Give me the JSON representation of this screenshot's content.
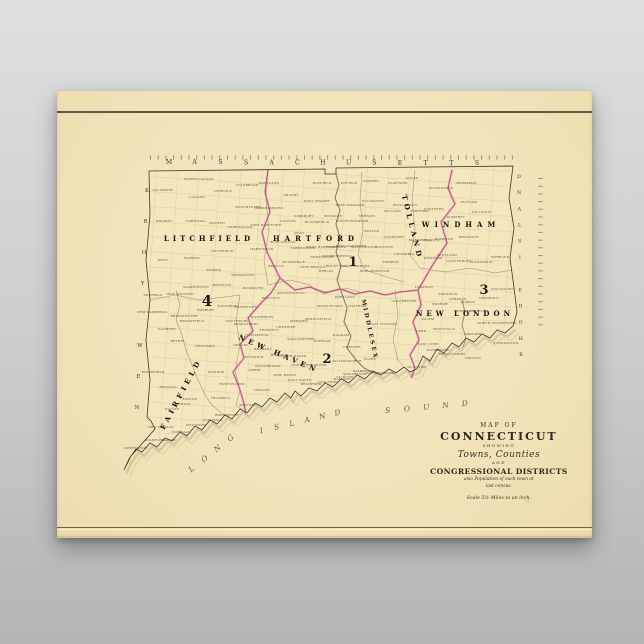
{
  "scene": {
    "background_top": "#dfdfdf",
    "background_bottom": "#b4b4b4"
  },
  "poster": {
    "paper_color": "#f1e2b8",
    "ink_color": "#3a352b",
    "district_line_color": "#c4618f",
    "page_mark": "22"
  },
  "cartouche": {
    "map_of": "MAP OF",
    "state_name": "CONNECTICUT",
    "showing": "SHOWING",
    "towns_counties": "Towns, Counties",
    "and_word": "AND",
    "congressional": "CONGRESSIONAL DISTRICTS",
    "note_line1": "also Population of each town at",
    "note_line2": "last census.",
    "scale_note": "Scale 5½ Miles to an inch."
  },
  "map": {
    "border_states": [
      {
        "name": "massachusetts-label",
        "text": "MASSACHUSETTS",
        "x1": 169,
        "y1": 164,
        "x2": 477,
        "y2": 165,
        "size": 6.2
      },
      {
        "name": "new-york-label",
        "text": "NEW YORK",
        "x1": 137,
        "y1": 409,
        "x2": 147,
        "y2": 192,
        "size": 5.4
      },
      {
        "name": "rhode-island-label",
        "text": "RHODE ISLAND",
        "x1": 521,
        "y1": 356,
        "x2": 519,
        "y2": 178,
        "size": 4.6
      }
    ],
    "water_words": [
      {
        "text": "LONG",
        "x1": 193,
        "y1": 471,
        "x2": 232,
        "y2": 440
      },
      {
        "text": "ISLAND",
        "x1": 262,
        "y1": 433,
        "x2": 338,
        "y2": 415
      },
      {
        "text": "SOUND",
        "x1": 388,
        "y1": 413,
        "x2": 465,
        "y2": 406
      }
    ],
    "counties": [
      {
        "name": "LITCHFIELD",
        "x": 209,
        "y": 241,
        "rot": 0,
        "size": 7,
        "ls": 4
      },
      {
        "name": "HARTFORD",
        "x": 316,
        "y": 241,
        "rot": 0,
        "size": 7,
        "ls": 5
      },
      {
        "name": "TOLLAND",
        "x": 410,
        "y": 228,
        "rot": 76,
        "size": 7,
        "ls": 4
      },
      {
        "name": "WINDHAM",
        "x": 461,
        "y": 227,
        "rot": 0,
        "size": 7,
        "ls": 5
      },
      {
        "name": "NEW LONDON",
        "x": 465,
        "y": 316,
        "rot": 0,
        "size": 7,
        "ls": 4
      },
      {
        "name": "MIDDLESEX",
        "x": 368,
        "y": 330,
        "rot": 78,
        "size": 5.6,
        "ls": 2.5
      },
      {
        "name": "NEW HAVEN",
        "x": 278,
        "y": 356,
        "rot": 23,
        "size": 7,
        "ls": 4
      },
      {
        "name": "FAIRFIELD",
        "x": 183,
        "y": 395,
        "rot": -62,
        "size": 7,
        "ls": 4
      }
    ],
    "districts": [
      {
        "num": "1",
        "x": 353,
        "y": 266,
        "size": 13
      },
      {
        "num": "2",
        "x": 327,
        "y": 363,
        "size": 13
      },
      {
        "num": "3",
        "x": 484,
        "y": 294,
        "size": 13
      },
      {
        "num": "4",
        "x": 207,
        "y": 306,
        "size": 15
      }
    ],
    "towns": [
      {
        "n": "SALISBURY",
        "x": 163,
        "y": 191
      },
      {
        "n": "NORTH CANAAN",
        "x": 199,
        "y": 180
      },
      {
        "n": "CANAAN",
        "x": 197,
        "y": 198
      },
      {
        "n": "NORFOLK",
        "x": 223,
        "y": 192
      },
      {
        "n": "COLEBROOK",
        "x": 247,
        "y": 186
      },
      {
        "n": "WINCHESTER",
        "x": 248,
        "y": 208
      },
      {
        "n": "BARKHAMSTED",
        "x": 269,
        "y": 209
      },
      {
        "n": "SHARON",
        "x": 164,
        "y": 222
      },
      {
        "n": "CORNWALL",
        "x": 196,
        "y": 222
      },
      {
        "n": "GOSHEN",
        "x": 217,
        "y": 224
      },
      {
        "n": "TORRINGTON",
        "x": 240,
        "y": 228
      },
      {
        "n": "NEW HARTFORD",
        "x": 266,
        "y": 226
      },
      {
        "n": "KENT",
        "x": 163,
        "y": 261
      },
      {
        "n": "WARREN",
        "x": 192,
        "y": 259
      },
      {
        "n": "LITCHFIELD",
        "x": 222,
        "y": 252
      },
      {
        "n": "MORRIS",
        "x": 214,
        "y": 271
      },
      {
        "n": "HARWINTON",
        "x": 262,
        "y": 250
      },
      {
        "n": "THOMASTON",
        "x": 243,
        "y": 276
      },
      {
        "n": "WASHINGTON",
        "x": 196,
        "y": 288
      },
      {
        "n": "BETHLEM",
        "x": 222,
        "y": 286
      },
      {
        "n": "WOODBURY",
        "x": 228,
        "y": 307
      },
      {
        "n": "NEW MILFORD",
        "x": 180,
        "y": 295
      },
      {
        "n": "ROXBURY",
        "x": 206,
        "y": 311
      },
      {
        "n": "BRIDGEWATER",
        "x": 184,
        "y": 317
      },
      {
        "n": "SOUTHBURY",
        "x": 237,
        "y": 322
      },
      {
        "n": "NEW FAIRFIELD",
        "x": 152,
        "y": 313
      },
      {
        "n": "SHERMAN",
        "x": 153,
        "y": 296
      },
      {
        "n": "PLYMOUTH",
        "x": 253,
        "y": 289
      },
      {
        "n": "DANBURY",
        "x": 167,
        "y": 330
      },
      {
        "n": "BROOKFIELD",
        "x": 192,
        "y": 322
      },
      {
        "n": "BETHEL",
        "x": 178,
        "y": 342
      },
      {
        "n": "NEWTOWN",
        "x": 205,
        "y": 347
      },
      {
        "n": "MONROE",
        "x": 216,
        "y": 373
      },
      {
        "n": "REDDING",
        "x": 168,
        "y": 388
      },
      {
        "n": "RIDGEFIELD",
        "x": 153,
        "y": 373
      },
      {
        "n": "EASTON",
        "x": 190,
        "y": 400
      },
      {
        "n": "TRUMBULL",
        "x": 221,
        "y": 399
      },
      {
        "n": "HUNTINGTON",
        "x": 232,
        "y": 385
      },
      {
        "n": "BRIDGEPORT",
        "x": 227,
        "y": 416
      },
      {
        "n": "FAIRFIELD",
        "x": 213,
        "y": 421
      },
      {
        "n": "WESTPORT",
        "x": 196,
        "y": 426
      },
      {
        "n": "WESTON",
        "x": 183,
        "y": 405
      },
      {
        "n": "WILTON",
        "x": 172,
        "y": 410
      },
      {
        "n": "NEW CANAAN",
        "x": 161,
        "y": 428
      },
      {
        "n": "NORWALK",
        "x": 181,
        "y": 433
      },
      {
        "n": "DARIEN",
        "x": 169,
        "y": 441
      },
      {
        "n": "STAMFORD",
        "x": 155,
        "y": 441
      },
      {
        "n": "GREENWICH",
        "x": 136,
        "y": 449
      },
      {
        "n": "WATERBURY",
        "x": 262,
        "y": 318
      },
      {
        "n": "NAUGATUCK",
        "x": 257,
        "y": 336
      },
      {
        "n": "MIDDLEBURY",
        "x": 246,
        "y": 325
      },
      {
        "n": "WATERTOWN",
        "x": 246,
        "y": 308
      },
      {
        "n": "WOLCOTT",
        "x": 271,
        "y": 299
      },
      {
        "n": "PROSPECT",
        "x": 269,
        "y": 331
      },
      {
        "n": "CHESHIRE",
        "x": 286,
        "y": 328
      },
      {
        "n": "SOUTHINGTON",
        "x": 291,
        "y": 294
      },
      {
        "n": "MERIDEN",
        "x": 299,
        "y": 322
      },
      {
        "n": "WALLINGFORD",
        "x": 301,
        "y": 340
      },
      {
        "n": "OXFORD",
        "x": 241,
        "y": 346
      },
      {
        "n": "SEYMOUR",
        "x": 254,
        "y": 358
      },
      {
        "n": "DERBY",
        "x": 255,
        "y": 371
      },
      {
        "n": "BETHANY",
        "x": 263,
        "y": 350
      },
      {
        "n": "WOODBRIDGE",
        "x": 268,
        "y": 367
      },
      {
        "n": "ORANGE",
        "x": 262,
        "y": 391
      },
      {
        "n": "MILFORD",
        "x": 248,
        "y": 406
      },
      {
        "n": "NEW HAVEN",
        "x": 285,
        "y": 376
      },
      {
        "n": "HAMDEN",
        "x": 279,
        "y": 356
      },
      {
        "n": "NORTH HAVEN",
        "x": 293,
        "y": 357
      },
      {
        "n": "EAST HAVEN",
        "x": 300,
        "y": 381
      },
      {
        "n": "BRANFORD",
        "x": 311,
        "y": 385
      },
      {
        "n": "NORTH BRANFORD",
        "x": 309,
        "y": 366
      },
      {
        "n": "GUILFORD",
        "x": 328,
        "y": 383
      },
      {
        "n": "MADISON",
        "x": 342,
        "y": 380
      },
      {
        "n": "HARTLAND",
        "x": 269,
        "y": 184
      },
      {
        "n": "GRANBY",
        "x": 291,
        "y": 196
      },
      {
        "n": "SUFFIELD",
        "x": 322,
        "y": 184
      },
      {
        "n": "ENFIELD",
        "x": 349,
        "y": 184
      },
      {
        "n": "EAST GRANBY",
        "x": 317,
        "y": 202
      },
      {
        "n": "EAST WINDSOR",
        "x": 350,
        "y": 206
      },
      {
        "n": "SOUTH WINDSOR",
        "x": 352,
        "y": 222
      },
      {
        "n": "WINDSOR",
        "x": 333,
        "y": 217
      },
      {
        "n": "BLOOMFIELD",
        "x": 317,
        "y": 223
      },
      {
        "n": "SIMSBURY",
        "x": 304,
        "y": 217
      },
      {
        "n": "CANTON",
        "x": 288,
        "y": 222
      },
      {
        "n": "AVON",
        "x": 299,
        "y": 234
      },
      {
        "n": "BURLINGTON",
        "x": 283,
        "y": 243
      },
      {
        "n": "FARMINGTON",
        "x": 303,
        "y": 249
      },
      {
        "n": "WEST HARTFORD",
        "x": 322,
        "y": 248
      },
      {
        "n": "HARTFORD",
        "x": 336,
        "y": 248
      },
      {
        "n": "EAST HARTFORD",
        "x": 351,
        "y": 247
      },
      {
        "n": "MANCHESTER",
        "x": 364,
        "y": 248
      },
      {
        "n": "GLASTONBURY",
        "x": 356,
        "y": 267
      },
      {
        "n": "WETHERSFIELD",
        "x": 337,
        "y": 257
      },
      {
        "n": "NEWINGTON",
        "x": 322,
        "y": 258
      },
      {
        "n": "NEW BRITAIN",
        "x": 313,
        "y": 268
      },
      {
        "n": "BERLIN",
        "x": 326,
        "y": 272
      },
      {
        "n": "ROCKY HILL",
        "x": 337,
        "y": 267
      },
      {
        "n": "PLAINVILLE",
        "x": 294,
        "y": 263
      },
      {
        "n": "BRISTOL",
        "x": 276,
        "y": 267
      },
      {
        "n": "MARLBOROUGH",
        "x": 375,
        "y": 272
      },
      {
        "n": "SOMERS",
        "x": 371,
        "y": 182
      },
      {
        "n": "STAFFORD",
        "x": 398,
        "y": 184
      },
      {
        "n": "ELLINGTON",
        "x": 373,
        "y": 202
      },
      {
        "n": "TOLLAND",
        "x": 392,
        "y": 212
      },
      {
        "n": "WILLINGTON",
        "x": 405,
        "y": 206
      },
      {
        "n": "VERNON",
        "x": 367,
        "y": 217
      },
      {
        "n": "BOLTON",
        "x": 372,
        "y": 232
      },
      {
        "n": "COVENTRY",
        "x": 394,
        "y": 238
      },
      {
        "n": "ANDOVER",
        "x": 384,
        "y": 248
      },
      {
        "n": "HEBRON",
        "x": 391,
        "y": 263
      },
      {
        "n": "COLUMBIA",
        "x": 404,
        "y": 255
      },
      {
        "n": "UNION",
        "x": 412,
        "y": 179
      },
      {
        "n": "WOODSTOCK",
        "x": 441,
        "y": 189
      },
      {
        "n": "THOMPSON",
        "x": 466,
        "y": 184
      },
      {
        "n": "PUTNAM",
        "x": 469,
        "y": 203
      },
      {
        "n": "ASHFORD",
        "x": 419,
        "y": 212
      },
      {
        "n": "EASTFORD",
        "x": 434,
        "y": 210
      },
      {
        "n": "POMFRET",
        "x": 456,
        "y": 218
      },
      {
        "n": "KILLINGLY",
        "x": 482,
        "y": 213
      },
      {
        "n": "CHAPLIN",
        "x": 431,
        "y": 241
      },
      {
        "n": "HAMPTON",
        "x": 444,
        "y": 240
      },
      {
        "n": "BROOKLYN",
        "x": 469,
        "y": 238
      },
      {
        "n": "MANSFIELD",
        "x": 420,
        "y": 241
      },
      {
        "n": "WINDHAM",
        "x": 433,
        "y": 259
      },
      {
        "n": "SCOTLAND",
        "x": 447,
        "y": 256
      },
      {
        "n": "CANTERBURY",
        "x": 459,
        "y": 262
      },
      {
        "n": "PLAINFIELD",
        "x": 481,
        "y": 263
      },
      {
        "n": "STERLING",
        "x": 500,
        "y": 258
      },
      {
        "n": "VOLUNTOWN",
        "x": 503,
        "y": 290
      },
      {
        "n": "LEBANON",
        "x": 424,
        "y": 288
      },
      {
        "n": "COLCHESTER",
        "x": 404,
        "y": 302
      },
      {
        "n": "FRANKLIN",
        "x": 448,
        "y": 295
      },
      {
        "n": "SPRAGUE",
        "x": 458,
        "y": 300
      },
      {
        "n": "LISBON",
        "x": 468,
        "y": 303
      },
      {
        "n": "GRISWOLD",
        "x": 489,
        "y": 299
      },
      {
        "n": "NORWICH",
        "x": 463,
        "y": 312
      },
      {
        "n": "PRESTON",
        "x": 478,
        "y": 312
      },
      {
        "n": "BOZRAH",
        "x": 440,
        "y": 305
      },
      {
        "n": "SALEM",
        "x": 428,
        "y": 320
      },
      {
        "n": "MONTVILLE",
        "x": 444,
        "y": 330
      },
      {
        "n": "LEDYARD",
        "x": 473,
        "y": 335
      },
      {
        "n": "NORTH STONINGTON",
        "x": 497,
        "y": 324
      },
      {
        "n": "STONINGTON",
        "x": 506,
        "y": 344
      },
      {
        "n": "GROTON",
        "x": 473,
        "y": 359
      },
      {
        "n": "NEW LONDON",
        "x": 452,
        "y": 355
      },
      {
        "n": "WATERFORD",
        "x": 438,
        "y": 351
      },
      {
        "n": "EAST LYME",
        "x": 428,
        "y": 345
      },
      {
        "n": "LYME",
        "x": 421,
        "y": 332
      },
      {
        "n": "OLD LYME",
        "x": 417,
        "y": 368
      },
      {
        "n": "EAST HADDAM",
        "x": 383,
        "y": 325
      },
      {
        "n": "MIDDLETOWN",
        "x": 330,
        "y": 307
      },
      {
        "n": "PORTLAND",
        "x": 345,
        "y": 298
      },
      {
        "n": "CHATHAM",
        "x": 357,
        "y": 307
      },
      {
        "n": "MIDDLEFIELD",
        "x": 318,
        "y": 320
      },
      {
        "n": "DURHAM",
        "x": 322,
        "y": 342
      },
      {
        "n": "HADDAM",
        "x": 341,
        "y": 336
      },
      {
        "n": "KILLINGWORTH",
        "x": 347,
        "y": 362
      },
      {
        "n": "CHESTER",
        "x": 352,
        "y": 348
      },
      {
        "n": "ESSEX",
        "x": 370,
        "y": 360
      },
      {
        "n": "SAYBROOK",
        "x": 363,
        "y": 372
      },
      {
        "n": "OLD SAYBROOK",
        "x": 380,
        "y": 374
      },
      {
        "n": "WESTBROOK",
        "x": 355,
        "y": 375
      },
      {
        "n": "CLINTON",
        "x": 345,
        "y": 378
      }
    ]
  }
}
